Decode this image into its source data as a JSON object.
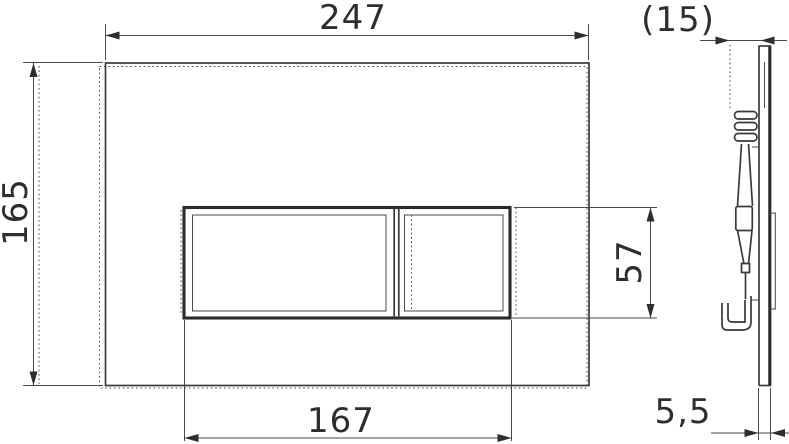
{
  "page": {
    "background": "#ffffff",
    "line_color": "#3a3a3a",
    "text_color": "#2e2e2e"
  },
  "drawing": {
    "type": "technical-dimension-drawing",
    "subject": "wc-flush-plate-front-and-side-view",
    "dimensions": {
      "plate_width": "247",
      "plate_height": "165",
      "button_area_width": "167",
      "button_area_height": "57",
      "depth_overall": "(15)",
      "plate_thickness": "5,5"
    }
  }
}
